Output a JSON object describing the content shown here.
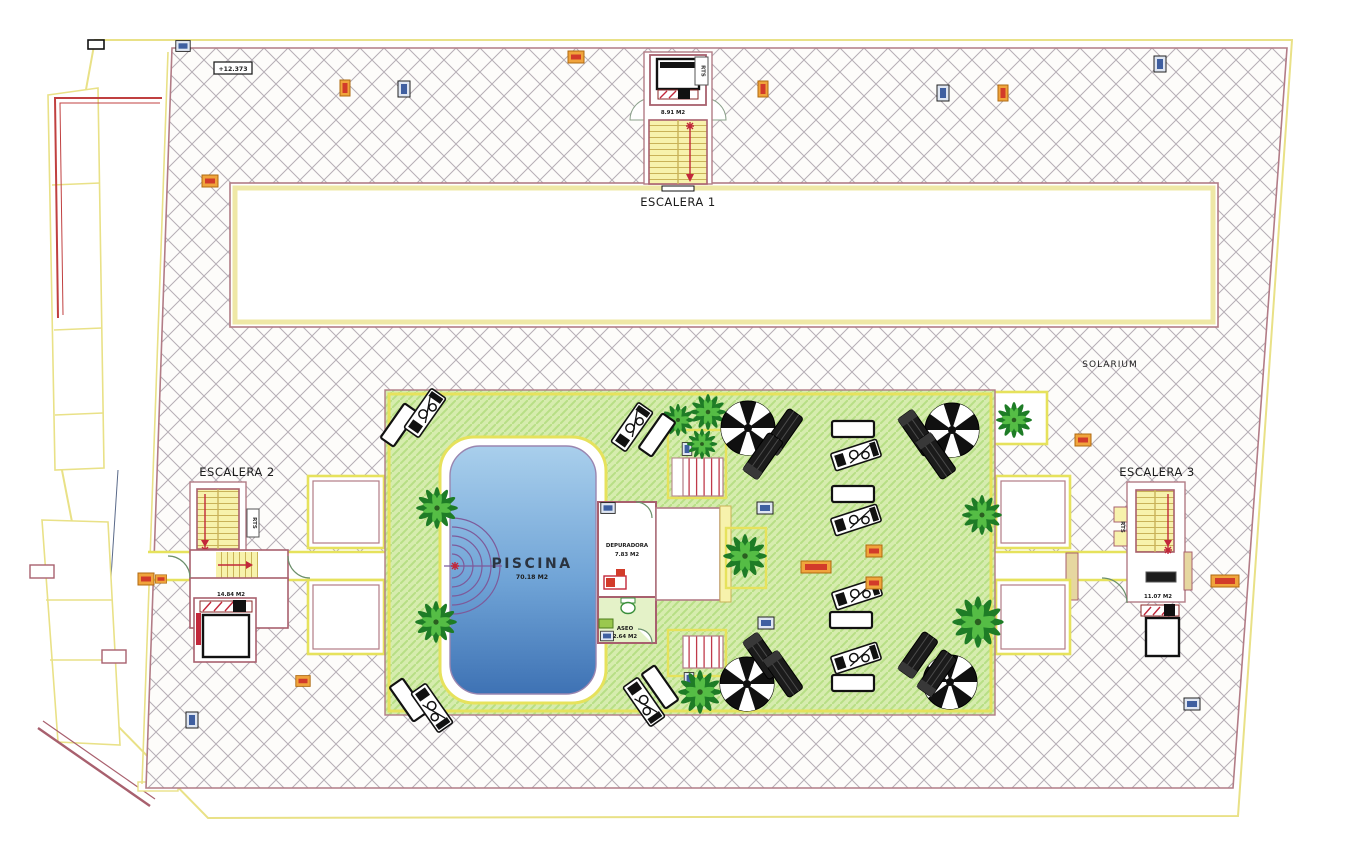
{
  "plan": {
    "stairwells": {
      "escalera1": {
        "name": "ESCALERA 1",
        "area": "8.91 M2",
        "rts": "RTS"
      },
      "escalera2": {
        "name": "ESCALERA 2",
        "area": "14.84 M2",
        "rts": "RTS"
      },
      "escalera3": {
        "name": "ESCALERA 3",
        "area": "11.07 M2",
        "rts": "RTS"
      }
    },
    "areas": {
      "solarium": "SOLARIUM",
      "piscina": {
        "name": "PISCINA",
        "area": "70.18 M2"
      },
      "depuradora": {
        "name": "DEPURADORA",
        "area": "7.83 M2"
      },
      "aseo": {
        "name": "ASEO",
        "area": "2.64 M2"
      }
    },
    "markers": {
      "elevation": "+12.373"
    },
    "colors": {
      "hatch_line": "#b6aeb6",
      "wall": "#a8606e",
      "parapet_yellow": "#e9e187",
      "terrace_green": "#d6ecae",
      "terrace_hatch": "#b7df85",
      "pool_light": "#a9cfec",
      "pool_dark": "#3e72b4",
      "stair_yellow": "#f7f2ac",
      "arrow_red": "#c2273a",
      "badge_orange": "#f0a43c",
      "badge_blue": "#3f5fa0"
    }
  }
}
